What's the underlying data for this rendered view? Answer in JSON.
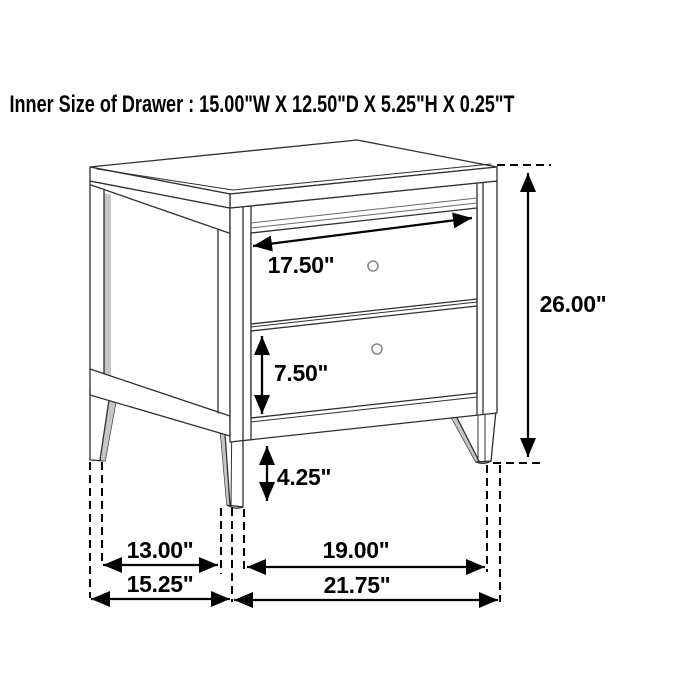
{
  "title": "Inner Size of Drawer : 15.00\"W X 12.50\"D X 5.25\"H X 0.25\"T",
  "diagram": {
    "subject": "two-drawer nightstand dimension drawing",
    "colors": {
      "background": "#ffffff",
      "outline": "#2f2f2f",
      "dimension": "#000000",
      "shade": "#c6c6c6",
      "knob": "#8a8a8a"
    },
    "labels": {
      "drawer_width": "17.50\"",
      "overall_height": "26.00\"",
      "lower_drawer_height": "7.50\"",
      "base_clearance": "4.25\"",
      "side_leg_spacing": "13.00\"",
      "overall_depth": "15.25\"",
      "front_leg_spacing": "19.00\"",
      "overall_width": "21.75\""
    }
  }
}
